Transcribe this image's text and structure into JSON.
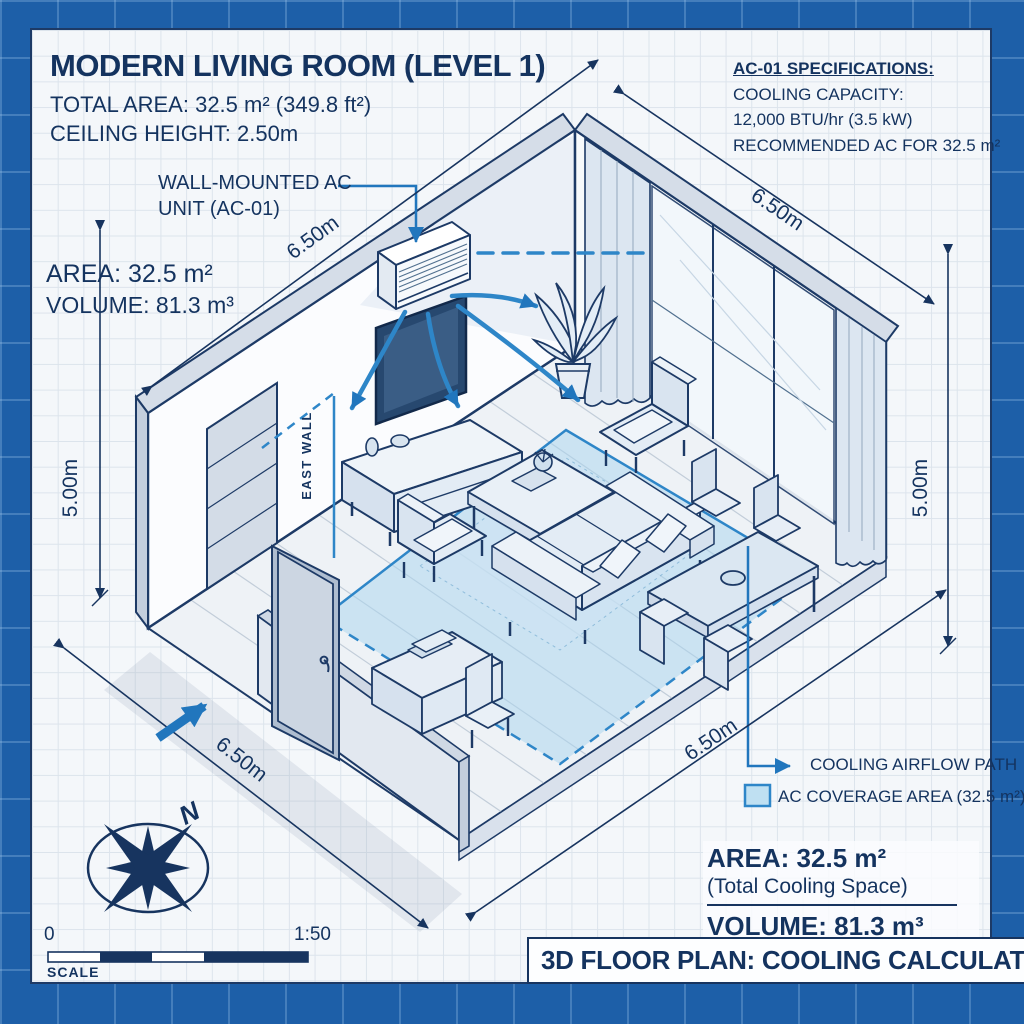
{
  "header": {
    "title": "MODERN LIVING ROOM (LEVEL 1)",
    "total_area": "TOTAL AREA: 32.5 m² (349.8 ft²)",
    "ceiling_height": "CEILING HEIGHT: 2.50m"
  },
  "ac_specs": {
    "title": "AC-01 SPECIFICATIONS:",
    "capacity_label": "COOLING CAPACITY:",
    "capacity_value": "12,000 BTU/hr (3.5 kW)",
    "recommendation": "RECOMMENDED AC FOR 32.5 m²"
  },
  "room_stats": {
    "area": "AREA: 32.5 m²",
    "volume": "VOLUME: 81.3 m³"
  },
  "ac_unit_label": {
    "line1": "WALL-MOUNTED AC",
    "line2": "UNIT (AC-01)"
  },
  "wall_label": "EAST WALL",
  "dimensions": {
    "top_left": "6.50m",
    "top_right": "6.50m",
    "left": "5.00m",
    "right": "5.00m",
    "bottom_left": "6.50m",
    "bottom_right": "6.50m"
  },
  "legend": {
    "airflow": "COOLING AIRFLOW PATH",
    "coverage": "AC COVERAGE AREA (32.5 m²)"
  },
  "summary": {
    "area": "AREA: 32.5 m²",
    "subtitle": "(Total Cooling Space)",
    "volume": "VOLUME: 81.3 m³"
  },
  "footer_title": "3D FLOOR PLAN: COOLING CALCULATION",
  "scale_bar": {
    "start": "0",
    "ratio": "1:50",
    "label": "SCALE"
  },
  "compass": {
    "north": "N"
  },
  "colors": {
    "accent_blue": "#2e86c8",
    "leader_blue": "#2176bd",
    "navy": "#14335f",
    "coverage_fill": "#bfe0f2",
    "frame_blue": "#1d5fa8"
  }
}
